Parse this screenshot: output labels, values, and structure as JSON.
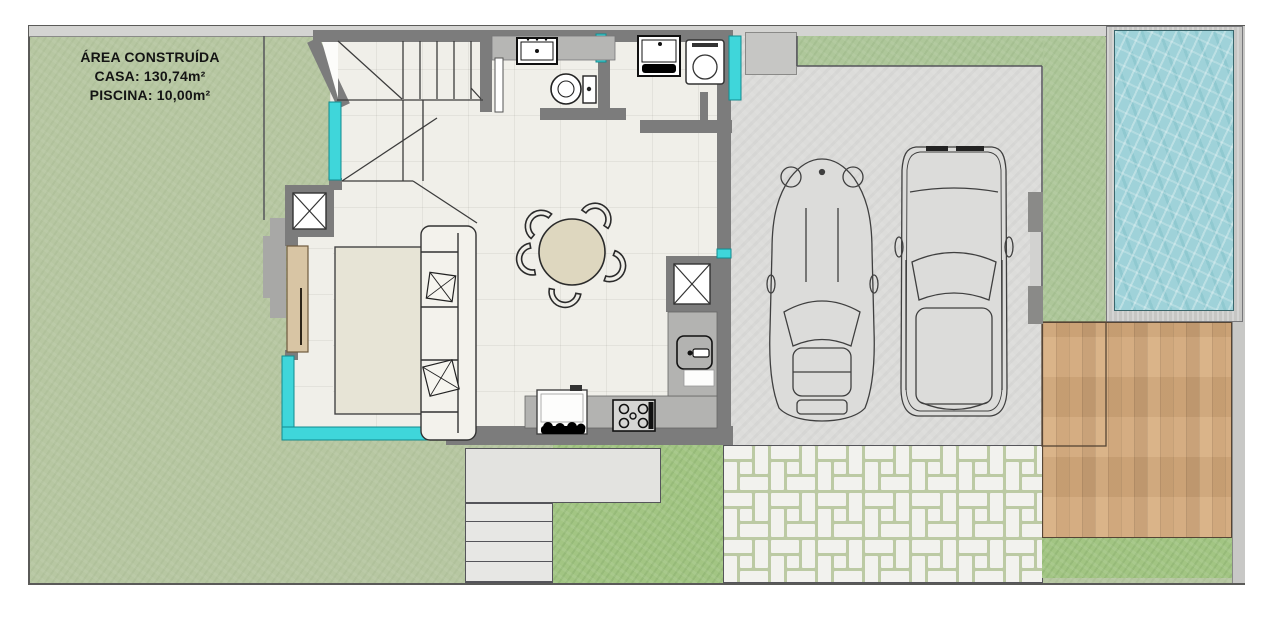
{
  "legend": {
    "title": "ÁREA CONSTRUÍDA",
    "casa": "CASA: 130,74m²",
    "piscina": "PISCINA: 10,00m²"
  },
  "plan": {
    "type": "residential-floor-plan",
    "features": [
      "front-lawn",
      "swimming-pool",
      "wood-deck",
      "paver-driveway",
      "garage-slab",
      "sports-car",
      "suv-car",
      "living-room-sofa",
      "area-rug",
      "round-dining-table-5-chairs",
      "kitchen-counter-stove-sink",
      "bathroom-sink-toilet",
      "laundry-washtub-washer",
      "staircase",
      "entry-door",
      "corner-glass-windows",
      "front-steps",
      "structural-columns"
    ],
    "colors": {
      "lawn": "#b7c7a2",
      "lawn_dark": "#a2c583",
      "pool_water": "#9fd2d9",
      "deck_wood": "#d2a978",
      "wall": "#7c7c7c",
      "window_glass": "#3fd6da",
      "interior_floor": "#f0efe9",
      "concrete": "#dcdcda",
      "paver": "#f2f2ee",
      "paver_joint": "#bccaa4",
      "door_wood": "#d8c5a4"
    }
  }
}
